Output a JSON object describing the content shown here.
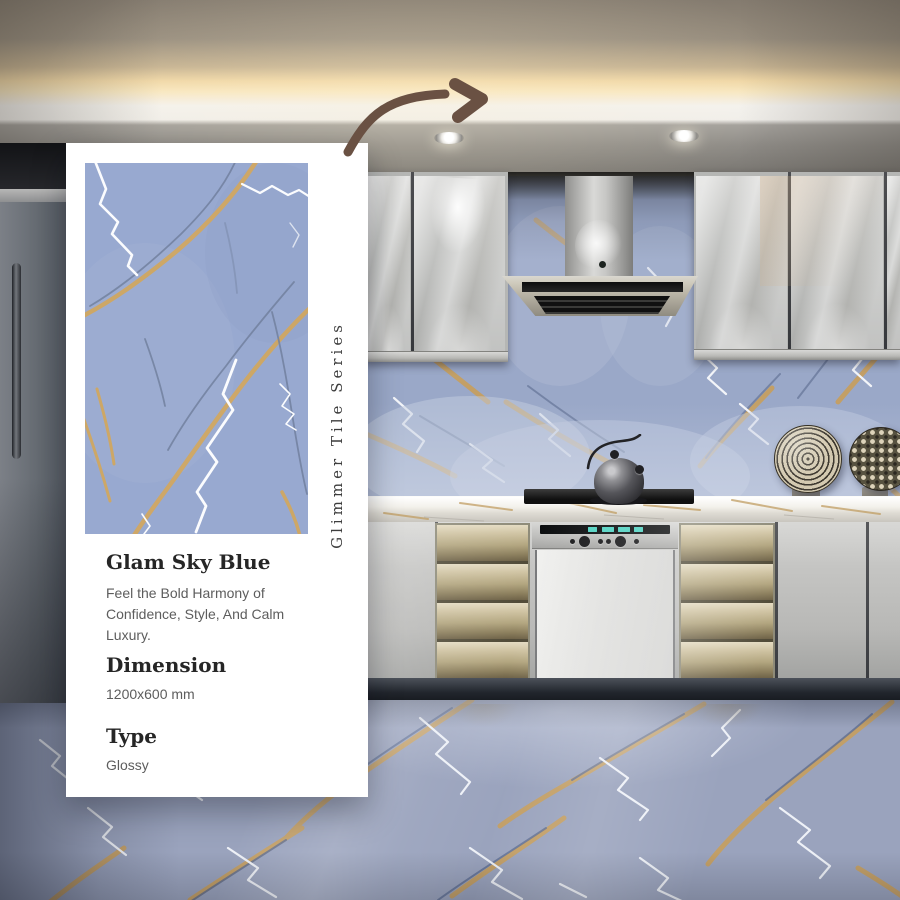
{
  "card": {
    "series_label": "Glimmer Tile Series",
    "product_name": "Glam Sky Blue",
    "description": "Feel the Bold Harmony of Confidence, Style, And Calm Luxury.",
    "dimension_label": "Dimension",
    "dimension_value": "1200x600 mm",
    "type_label": "Type",
    "type_value": "Glossy"
  },
  "colors": {
    "card_background": "#ffffff",
    "tile_blue": "#98a9d0",
    "vein_gold": "#d2a75e",
    "vein_white": "#fbfcfe",
    "vein_dark_blue": "#72819f",
    "arrow_brown": "#6a5143",
    "heading_text": "#262626",
    "body_text": "#5d5d5d",
    "cove_light": "#f8e7c0"
  }
}
